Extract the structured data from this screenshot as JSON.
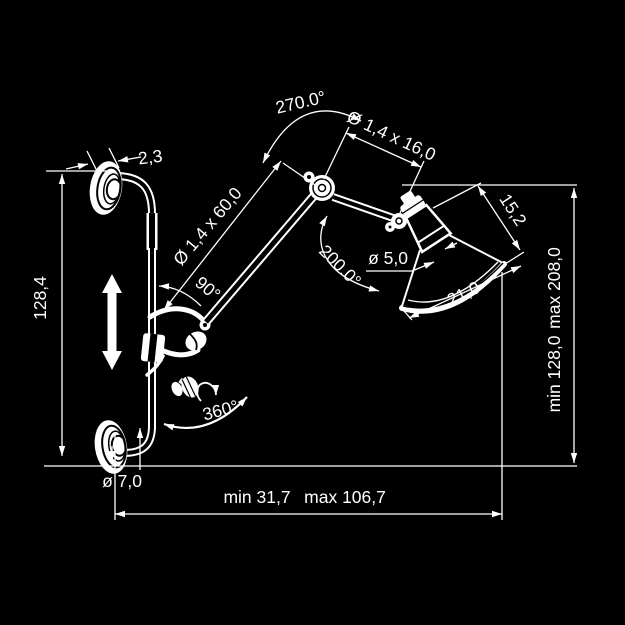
{
  "diagram": {
    "title": "wall-lamp-technical-drawing",
    "background": "#000000",
    "line_color": "#ffffff",
    "labels": {
      "mount_thickness": "2,3",
      "rod_length": "128,4",
      "lower_arm_size": "Ø 1,4 x 60,0",
      "lower_arm_angle": "90°",
      "elbow_rotation": "270.0°",
      "upper_arm_size": "Ø 1,4 x 16,0",
      "head_rotation": "200.0°",
      "socket_diameter": "ø 5,0",
      "shade_depth": "15,2",
      "shade_diameter": "21,0",
      "swivel_rotation": "360°",
      "flange_diameter": "ø 7,0",
      "reach_min": "min 31,7",
      "reach_max": "max 106,7",
      "height_min": "min 128,0",
      "height_max": "max 208,0"
    }
  }
}
